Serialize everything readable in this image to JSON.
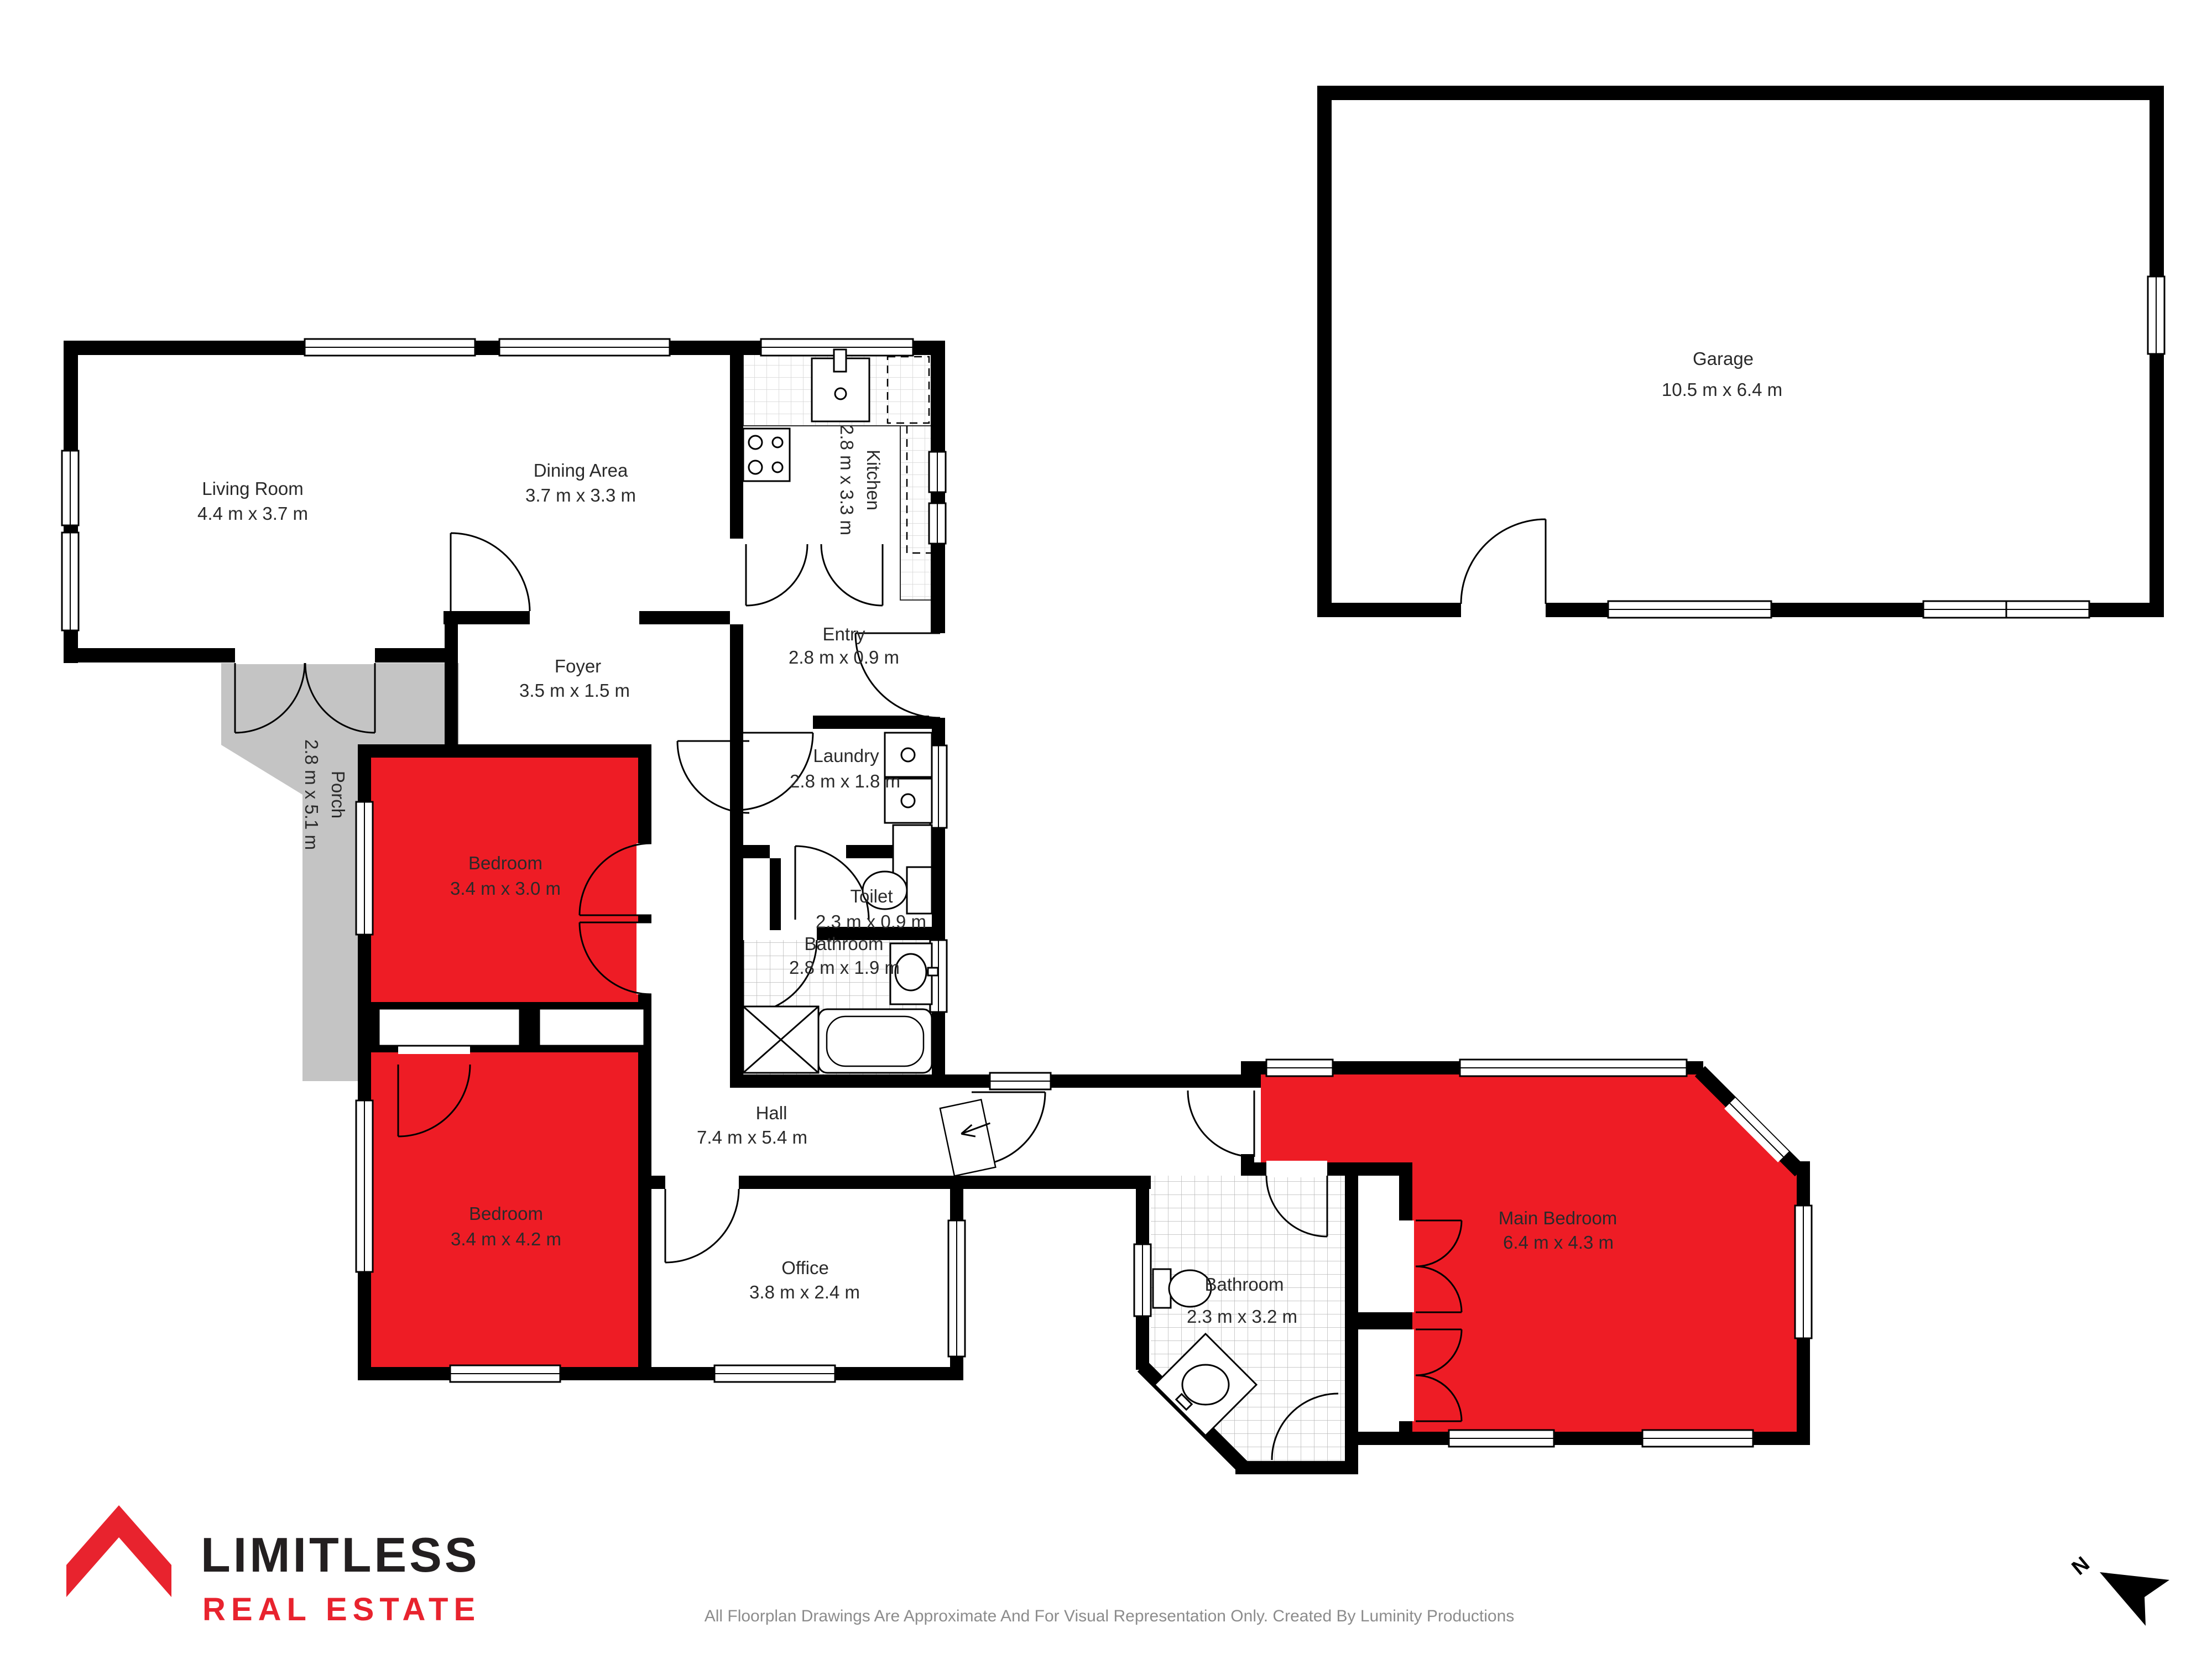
{
  "rooms": [
    {
      "name": "Living Room",
      "dims": "4.4 m x 3.7 m"
    },
    {
      "name": "Dining Area",
      "dims": "3.7 m x 3.3 m"
    },
    {
      "name": "Kitchen",
      "dims": "2.8 m x 3.3 m"
    },
    {
      "name": "Entry",
      "dims": "2.8 m x 0.9 m"
    },
    {
      "name": "Foyer",
      "dims": "3.5 m x 1.5 m"
    },
    {
      "name": "Porch",
      "dims": "2.8 m x 5.1 m"
    },
    {
      "name": "Laundry",
      "dims": "2.8 m x 1.8 m"
    },
    {
      "name": "Bedroom",
      "dims": "3.4 m x 3.0 m"
    },
    {
      "name": "Toilet",
      "dims": "2.3 m x 0.9 m"
    },
    {
      "name": "Bathroom",
      "dims": "2.8 m x 1.9 m"
    },
    {
      "name": "Hall",
      "dims": "7.4 m x 5.4 m"
    },
    {
      "name": "Bedroom",
      "dims": "3.4 m x 4.2 m"
    },
    {
      "name": "Office",
      "dims": "3.8 m x 2.4 m"
    },
    {
      "name": "Bathroom",
      "dims": "2.3 m x 3.2 m"
    },
    {
      "name": "Main Bedroom",
      "dims": "6.4 m x 4.3 m"
    },
    {
      "name": "Garage",
      "dims": "10.5 m x 6.4 m"
    }
  ],
  "footer": {
    "brand": "LIMITLESS",
    "brand_sub": "REAL ESTATE",
    "disclaimer": "All Floorplan Drawings Are Approximate And For Visual Representation Only. Created By Luminity Productions"
  },
  "north": {
    "label": "N"
  },
  "colors": {
    "highlight": "#ee1c25",
    "porch": "#c4c4c4",
    "wall": "#000000",
    "brand_red": "#e8232e",
    "tile_line": "#b9b9b9"
  }
}
